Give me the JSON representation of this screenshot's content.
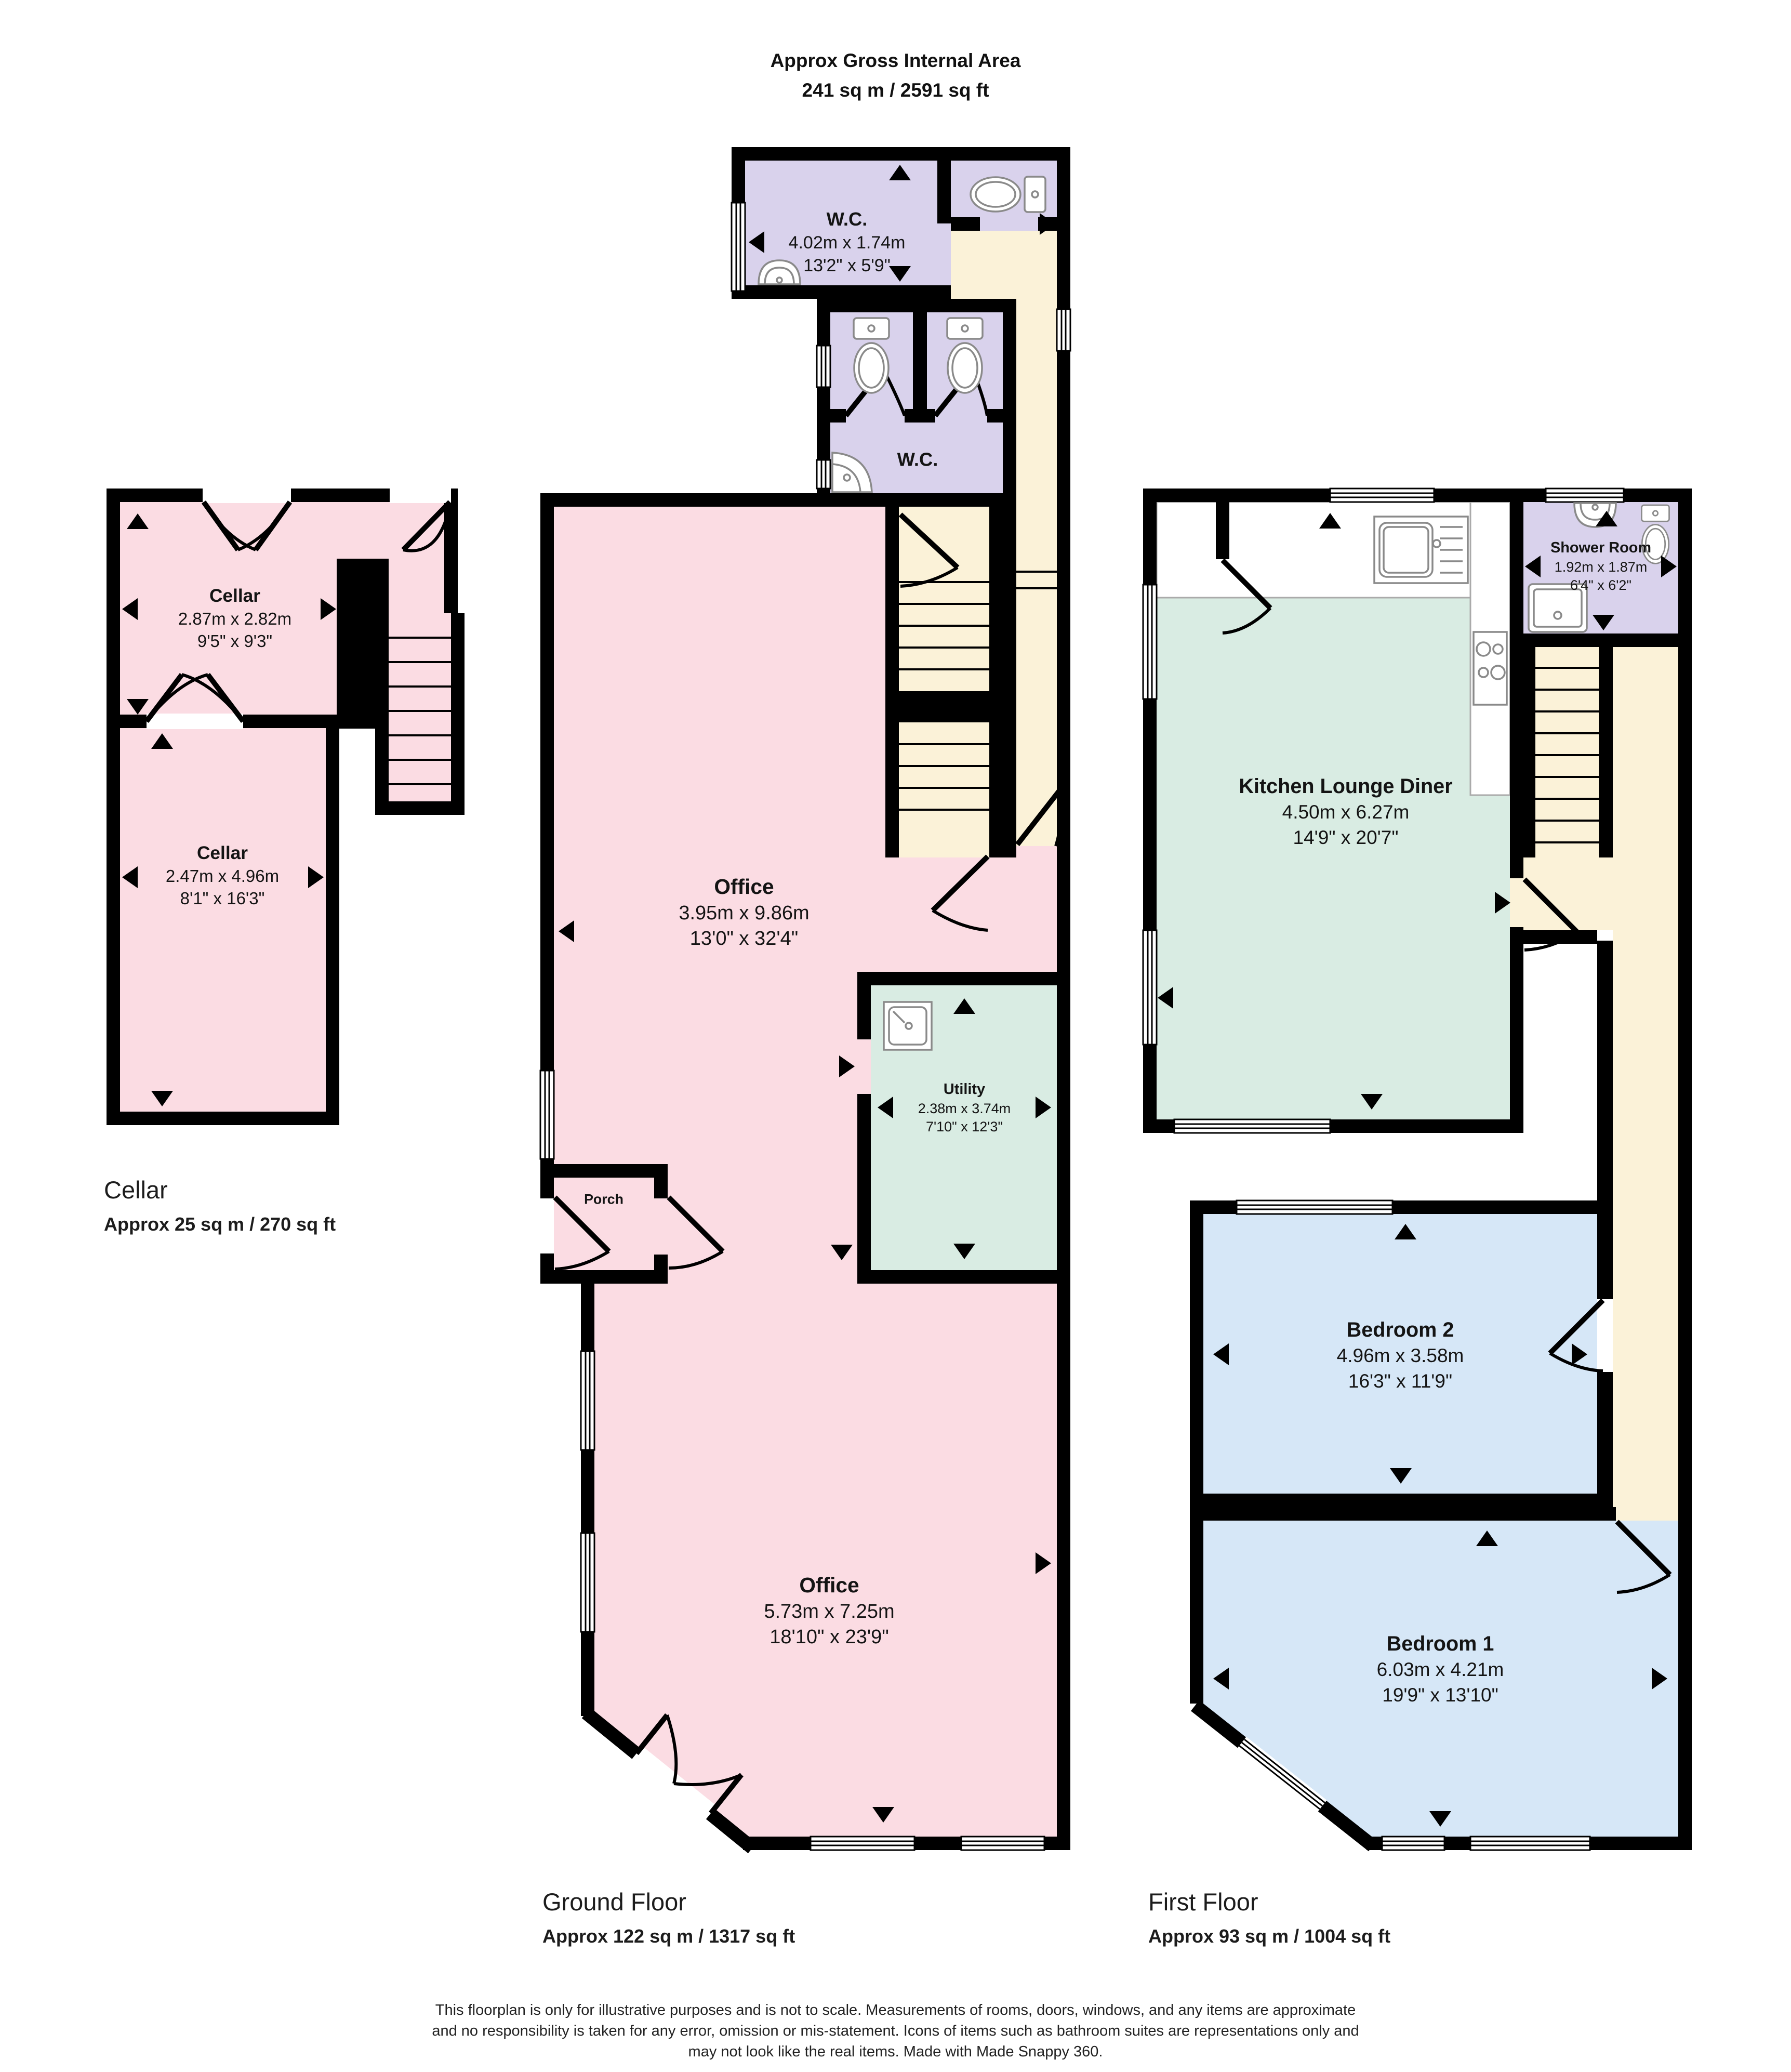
{
  "header": {
    "line1": "Approx Gross Internal Area",
    "line2": "241 sq m / 2591 sq ft"
  },
  "floors": {
    "cellar": {
      "label": "Cellar",
      "area": "Approx 25 sq m / 270 sq ft",
      "rooms": [
        {
          "name": "Cellar",
          "dim_m": "2.87m x 2.82m",
          "dim_ft": "9'5\" x 9'3\""
        },
        {
          "name": "Cellar",
          "dim_m": "2.47m x 4.96m",
          "dim_ft": "8'1\" x 16'3\""
        }
      ]
    },
    "ground": {
      "label": "Ground Floor",
      "area": "Approx 122 sq m / 1317 sq ft",
      "rooms": [
        {
          "name": "W.C.",
          "dim_m": "4.02m x 1.74m",
          "dim_ft": "13'2\" x 5'9\""
        },
        {
          "name": "W.C."
        },
        {
          "name": "Office",
          "dim_m": "3.95m x 9.86m",
          "dim_ft": "13'0\" x 32'4\""
        },
        {
          "name": "Utility",
          "dim_m": "2.38m x 3.74m",
          "dim_ft": "7'10\" x 12'3\""
        },
        {
          "name": "Porch"
        },
        {
          "name": "Office",
          "dim_m": "5.73m x 7.25m",
          "dim_ft": "18'10\" x 23'9\""
        }
      ]
    },
    "first": {
      "label": "First Floor",
      "area": "Approx 93 sq m / 1004 sq ft",
      "rooms": [
        {
          "name": "Kitchen Lounge Diner",
          "dim_m": "4.50m x 6.27m",
          "dim_ft": "14'9\" x 20'7\""
        },
        {
          "name": "Shower Room",
          "dim_m": "1.92m x 1.87m",
          "dim_ft": "6'4\" x 6'2\""
        },
        {
          "name": "Bedroom 2",
          "dim_m": "4.96m x 3.58m",
          "dim_ft": "16'3\" x 11'9\""
        },
        {
          "name": "Bedroom 1",
          "dim_m": "6.03m x 4.21m",
          "dim_ft": "19'9\" x 13'10\""
        }
      ]
    }
  },
  "footer": {
    "lines": [
      "This floorplan is only for illustrative purposes and is not to scale. Measurements of rooms, doors, windows, and any items are approximate",
      "and no responsibility is taken for any error, omission or mis-statement. Icons of items such as bathroom suites are representations only and",
      "may not look like the real items. Made with Made Snappy 360."
    ]
  },
  "colors": {
    "wall": "#000000",
    "room_pink": "#FBDCE3",
    "room_purple": "#D9D2EC",
    "room_cream": "#FBF2D8",
    "room_green": "#D9ECE3",
    "room_blue": "#D6E7F7"
  }
}
